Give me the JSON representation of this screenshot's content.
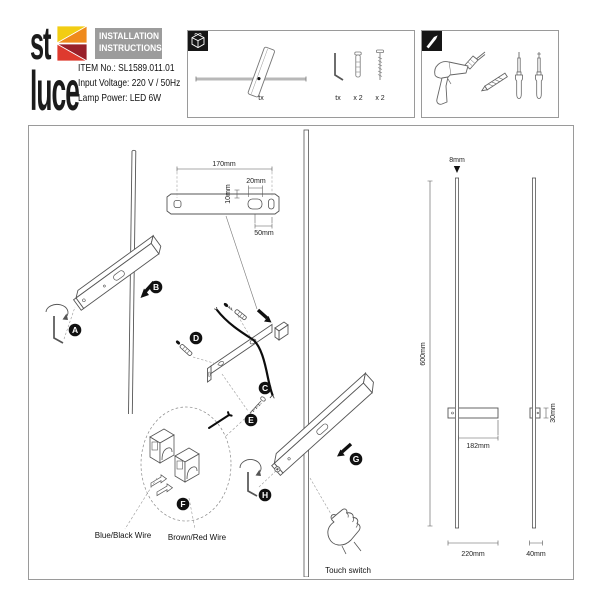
{
  "header": {
    "logo": {
      "top": "st",
      "bottom": "luce",
      "colors": {
        "yellow": "#f2cd13",
        "orange": "#ef8a1c",
        "red": "#de3a2e",
        "dark_red": "#99202a"
      }
    },
    "title_box": {
      "line1": "INSTALLATION",
      "line2": "INSTRUCTIONS"
    },
    "info": {
      "item_no": "ITEM No.: SL1589.011.01",
      "input_voltage": "Input Voltage: 220 V / 50Hz",
      "lamp_power": "Lamp Power: LED 6W"
    }
  },
  "parts_box": {
    "icon": "package-cube-icon",
    "assembly_tool_label": "tx",
    "items": [
      {
        "name": "hex-key",
        "qty": "tx"
      },
      {
        "name": "wall-plug",
        "qty": "x 2"
      },
      {
        "name": "screw",
        "qty": "x 2"
      }
    ]
  },
  "tools_box": {
    "icon": "drill-bit-icon"
  },
  "diagram": {
    "steps": [
      "A",
      "B",
      "C",
      "D",
      "E",
      "F",
      "G",
      "H"
    ],
    "dims": {
      "bracket_length": "170mm",
      "bracket_hole_offset": "10mm",
      "bracket_slot_width": "20mm",
      "bracket_end_offset": "50mm",
      "tube_diameter": "8mm",
      "tube_height": "600mm",
      "body_offset": "182mm",
      "body_length": "220mm",
      "body_depth": "30mm",
      "side_width": "40mm"
    },
    "labels": {
      "wire_blue": "Blue/Black Wire",
      "wire_brown": "Brown/Red Wire",
      "touch": "Touch switch"
    }
  }
}
